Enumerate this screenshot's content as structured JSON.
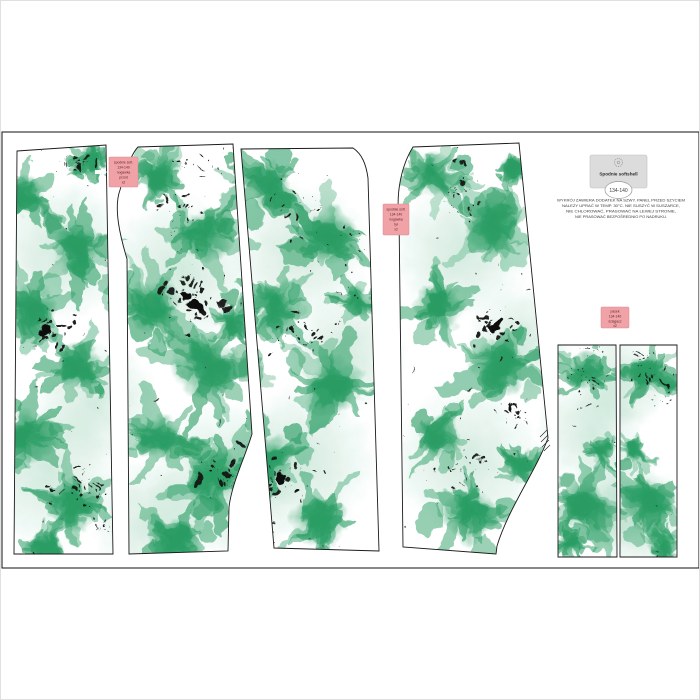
{
  "product": {
    "brand_label": {
      "logo_icon": "round-stamp-emblem",
      "title": "Spodnie softshell",
      "size_badge": "134-140"
    },
    "fine_print": {
      "lines": [
        "WYKRÓJ ZAWIERA DODATEK NA SZWY. PANEL PRZED SZYCIEM",
        "NALEŻY UPRAĆ W TEMP. 30°C. NIE SUSZYĆ W SUSZARCE,",
        "NIE CHLOROWAĆ, PRASOWAĆ NA LEWEJ STRONIE,",
        "NIE PRASOWAĆ BEZPOŚREDNIO PO NADRUKU."
      ]
    },
    "piece_labels": [
      {
        "lines": [
          "spodnie soft.",
          "134-140",
          "nogawka",
          "przód",
          "x2"
        ]
      },
      {
        "lines": [
          "spodnie soft.",
          "134-140",
          "nogawka",
          "tył",
          "x2"
        ]
      },
      {
        "lines": [
          "pasek",
          "134-140",
          "ściągacz",
          "x2"
        ]
      }
    ],
    "colors": {
      "print_green": "#2a9d64",
      "splatter_black": "#111111",
      "label_pink": "#f1a2a7",
      "label_pink_border": "#d98a90",
      "brand_label_bg": "#dcdcdc",
      "outline": "#1a1a1a"
    }
  }
}
